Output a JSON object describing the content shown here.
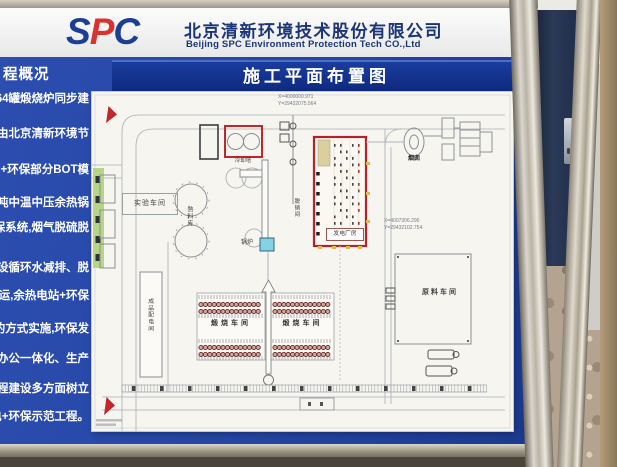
{
  "board": {
    "header": {
      "logo_s": "S",
      "logo_p": "P",
      "logo_c": "C",
      "company_cn": "北京清新环境技术股份有限公司",
      "company_en": "Beijing SPC Environment Protection Tech CO.,Ltd"
    },
    "sidebar": {
      "heading": "程概况",
      "lines": [
        "64罐煅烧炉同步建",
        "由北京清新环境节",
        "C+环保部分BOT模",
        "吨中温中压余热锅",
        "保系统,烟气脱硫脱",
        "步建设循环水减排、脱",
        "投运,余热电站+环保",
        "设的方式实施,环保发",
        "生产办公一体化、生产",
        "程、工程建设多方面树立",
        "电+环保示范工程。"
      ]
    },
    "plan_title": "施工平面布置图",
    "drawing": {
      "coords_top_x": "X=4000000.971",
      "coords_top_y": "Y=29432075.564",
      "coords_right_x": "X=4007306.296",
      "coords_right_y": "Y=29432102.754",
      "labels": {
        "cooling_tower": "冷却塔",
        "lab_workshop": "实验车间",
        "clinker_silo": "熟料库",
        "boiler": "锅炉",
        "denitration": "脱硝间",
        "power_plant": "发电厂房",
        "chimney": "烟囱",
        "product_distribution": "成品配电间",
        "calcination_ws_left": "煅烧车间",
        "calcination_ws_right": "煅烧车间",
        "raw_material_ws": "原料车间"
      }
    }
  },
  "colors": {
    "board_blue": "#2445a4",
    "title_blue": "#0e2a7e",
    "accent_red": "#c2262c",
    "logo_navy": "#1c3f96",
    "logo_red": "#d8332e",
    "boiler_cyan": "#86d2e4",
    "greenbelt": "#b5d687"
  }
}
